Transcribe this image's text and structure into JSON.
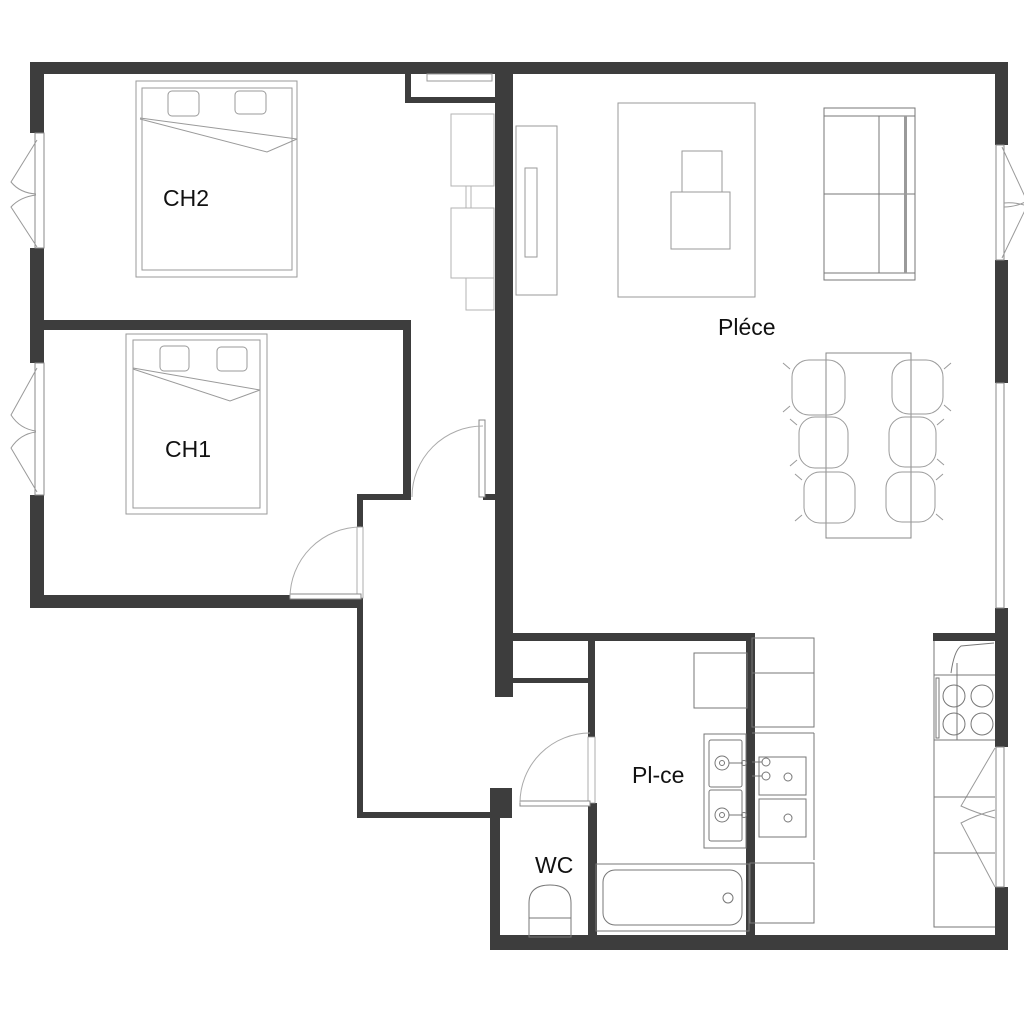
{
  "floorplan": {
    "background_color": "#ffffff",
    "wall_color": "#3d3d3d",
    "furniture_line_color": "#9a9a9a",
    "fixture_line_color": "#777777",
    "rooms": [
      {
        "id": "ch2",
        "label": "CH2"
      },
      {
        "id": "ch1",
        "label": "CH1"
      },
      {
        "id": "living",
        "label": "Pléce"
      },
      {
        "id": "bathroom",
        "label": "Pl-ce"
      },
      {
        "id": "wc",
        "label": "WC"
      }
    ]
  }
}
